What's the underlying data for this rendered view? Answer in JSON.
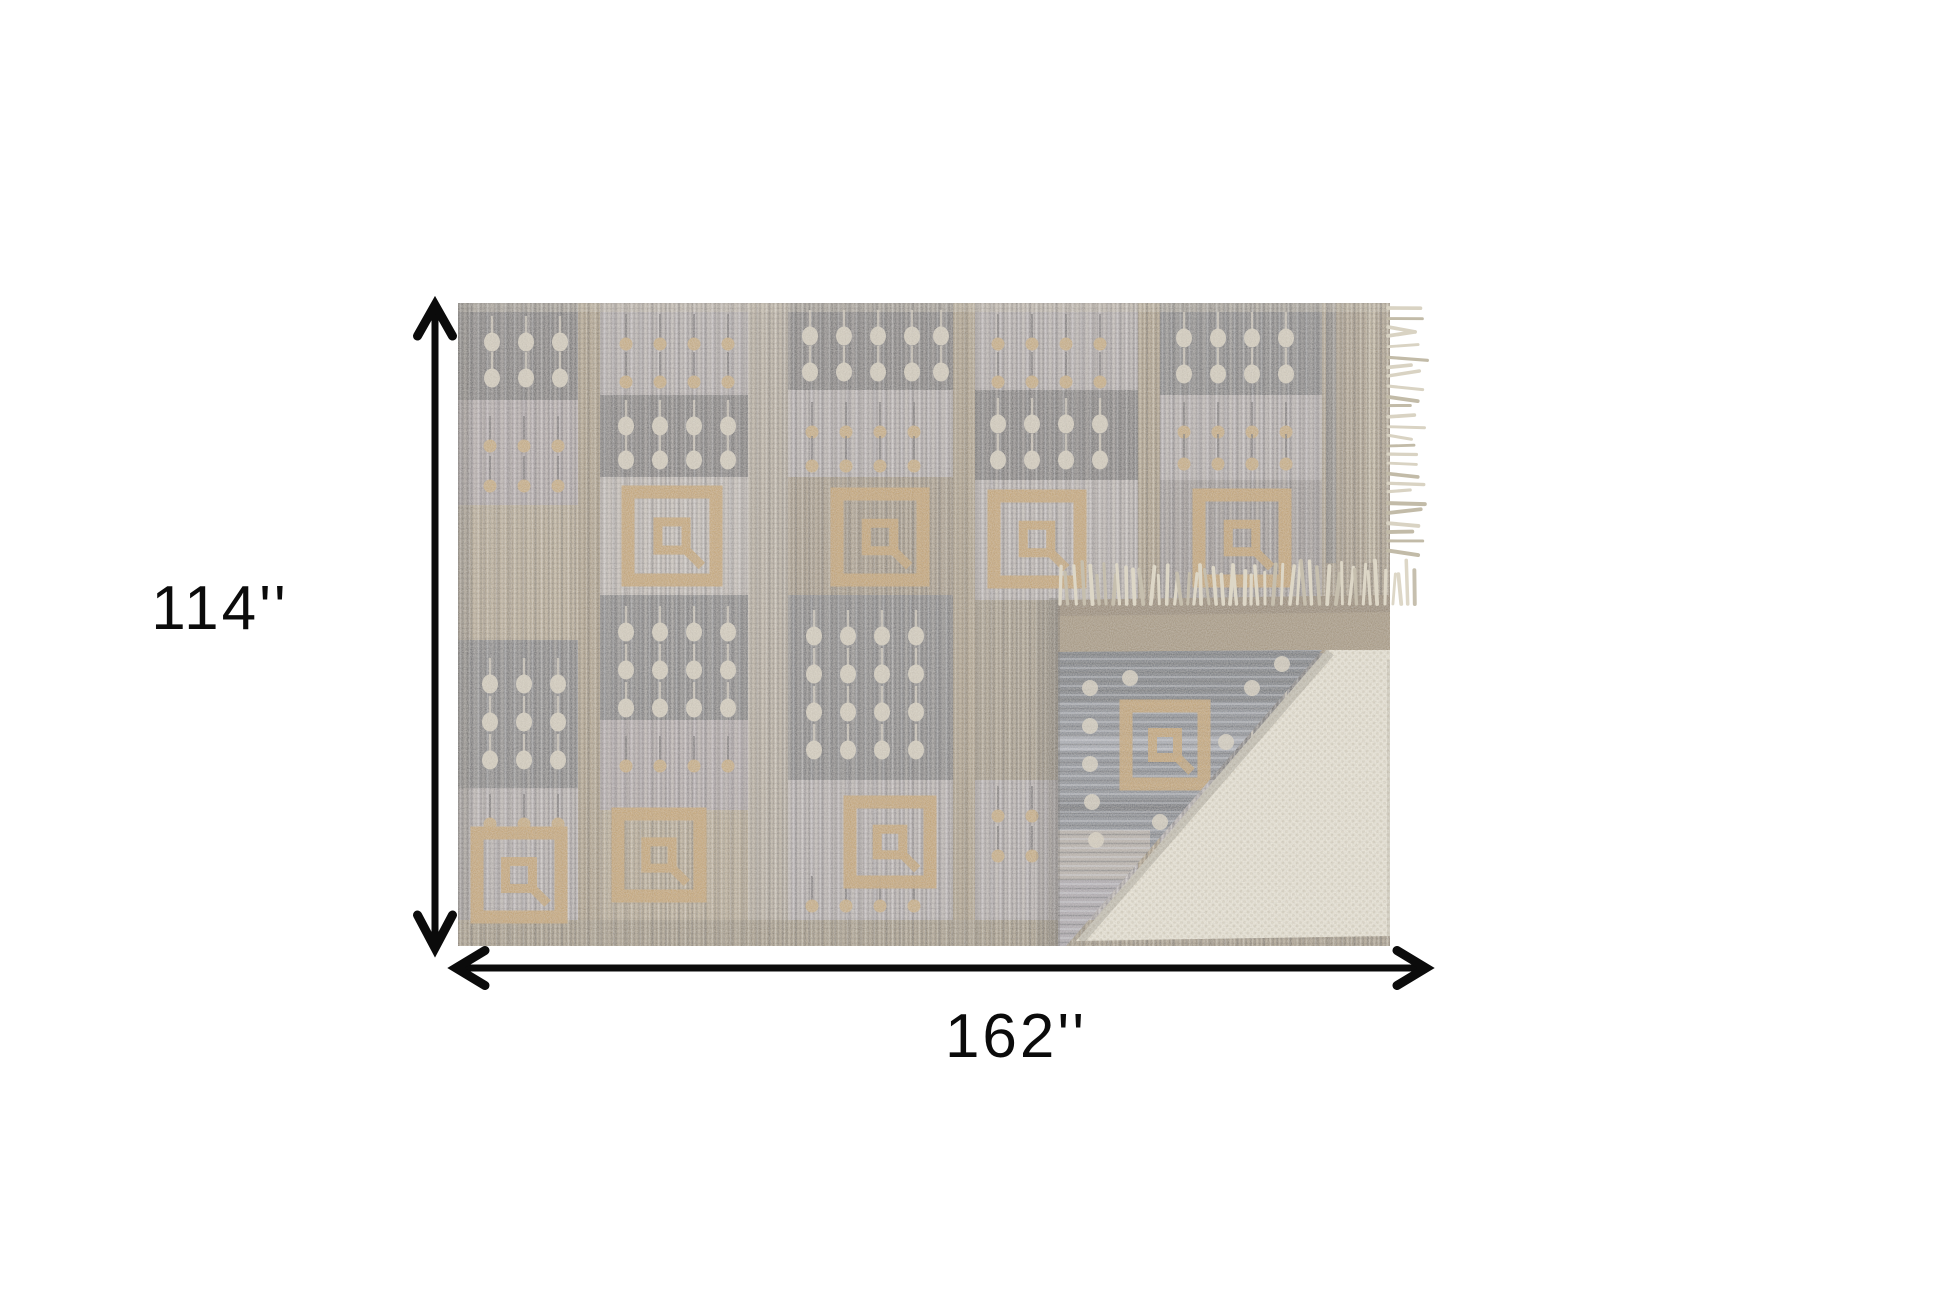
{
  "scene": {
    "type": "product-dimension-diagram",
    "background_color": "#ffffff",
    "product_alt": "Gray taupe and tan geometric patterned flatweave area rug with fringe, corner folded back over an ivory rug pad",
    "dimensions": {
      "height_label": "114''",
      "width_label": "162''"
    },
    "arrows": {
      "color": "#0b0b0b",
      "height_arrow": "vertical-double-arrow",
      "width_arrow": "horizontal-double-arrow"
    },
    "rug_palette": {
      "dark_gray": "#5c5b62",
      "slate": "#62646c",
      "light_gray": "#aaa4a8",
      "pale_gray": "#bab4b2",
      "lavender": "#a59ca2",
      "tan": "#9c8a6c",
      "sep_light": "#aba092",
      "beige": "#ab9b80",
      "brown": "#93836c",
      "gold": "#c49c57",
      "cream_dot": "#d9d2c1",
      "back_blue_gray": "#78808d",
      "back_dark": "#5f6874",
      "pad_cream": "#ece8da",
      "pad_dot": "#d8d2c0",
      "fringe": "#d9d3c3",
      "bottom_border": "#91836a",
      "right_border": "#97876e"
    }
  }
}
